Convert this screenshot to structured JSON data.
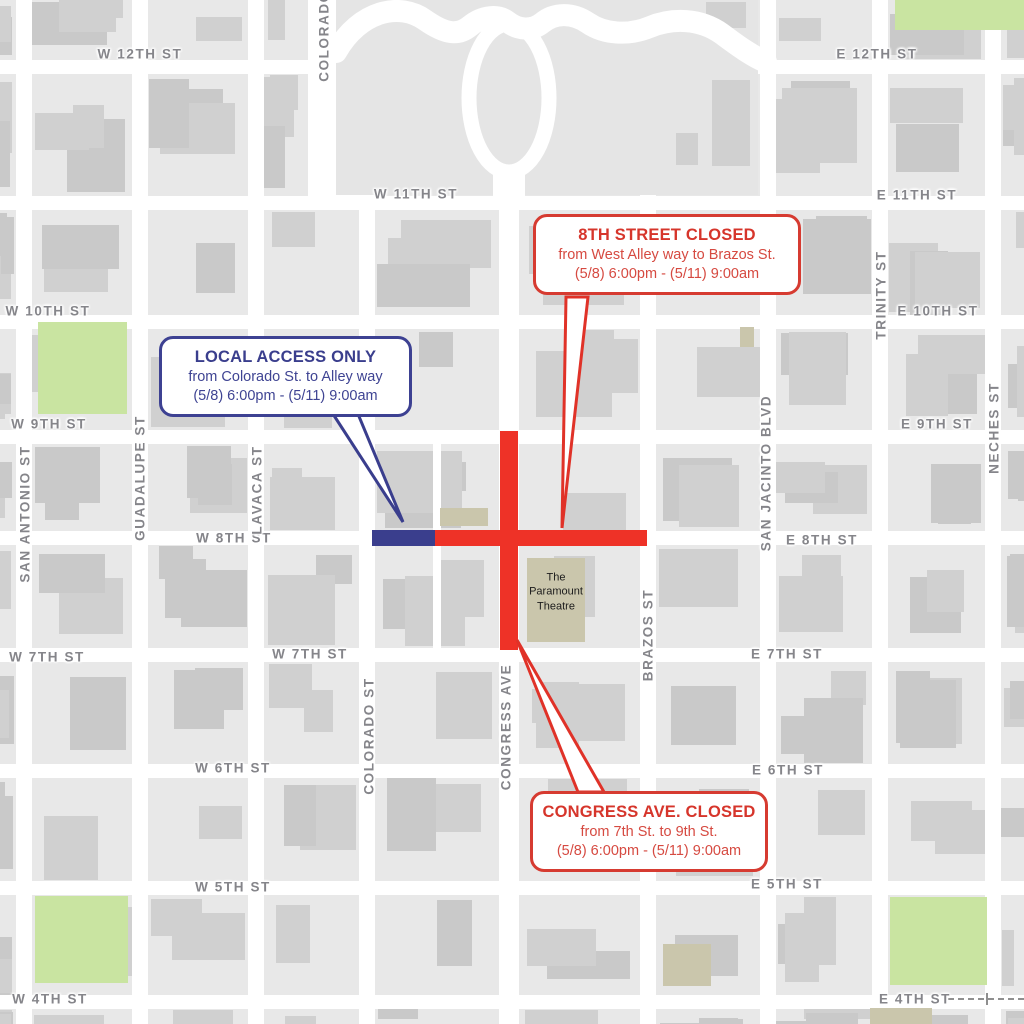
{
  "title": "Downtown street closure map",
  "colors": {
    "closure_red": "#ee3227",
    "local_access_blue": "#3a3e8d",
    "park_green": "#c9e4a1",
    "block_gray": "#e8e8e8",
    "building_gray": "#d0d0d0",
    "landmark_tan": "#cac6ac"
  },
  "street_labels": {
    "w12": "W 12TH ST",
    "e12": "E 12TH ST",
    "w11": "W 11TH ST",
    "e11": "E 11TH ST",
    "w10": "W 10TH ST",
    "e10": "E 10TH ST",
    "w9": "W 9TH ST",
    "e9": "E 9TH ST",
    "w8": "W 8TH ST",
    "e8": "E 8TH ST",
    "w7a": "W 7TH ST",
    "w7b": "W 7TH ST",
    "e7": "E 7TH ST",
    "w6": "W 6TH ST",
    "e6": "E 6TH ST",
    "w5": "W 5TH ST",
    "e5": "E 5TH ST",
    "w4": "W 4TH ST",
    "e4": "E 4TH ST",
    "colorado_top": "COLORADO",
    "san_antonio": "SAN ANTONIO ST",
    "guadalupe": "GUADALUPE ST",
    "lavaca": "LAVACA ST",
    "colorado": "COLORADO ST",
    "congress": "CONGRESS AVE",
    "brazos": "BRAZOS ST",
    "san_jacinto": "SAN JACINTO BLVD",
    "trinity": "TRINITY ST",
    "neches": "NECHES ST"
  },
  "landmarks": {
    "paramount": "The Paramount Theatre"
  },
  "callouts": {
    "eighth_street": {
      "title": "8TH STREET CLOSED",
      "line1": "from West Alley way to Brazos St.",
      "line2": "(5/8) 6:00pm - (5/11) 9:00am"
    },
    "local_access": {
      "title": "LOCAL ACCESS ONLY",
      "line1": "from Colorado St. to Alley way",
      "line2": "(5/8) 6:00pm - (5/11) 9:00am"
    },
    "congress_ave": {
      "title": "CONGRESS AVE. CLOSED",
      "line1": "from 7th St. to 9th St.",
      "line2": "(5/8) 6:00pm - (5/11) 9:00am"
    }
  }
}
